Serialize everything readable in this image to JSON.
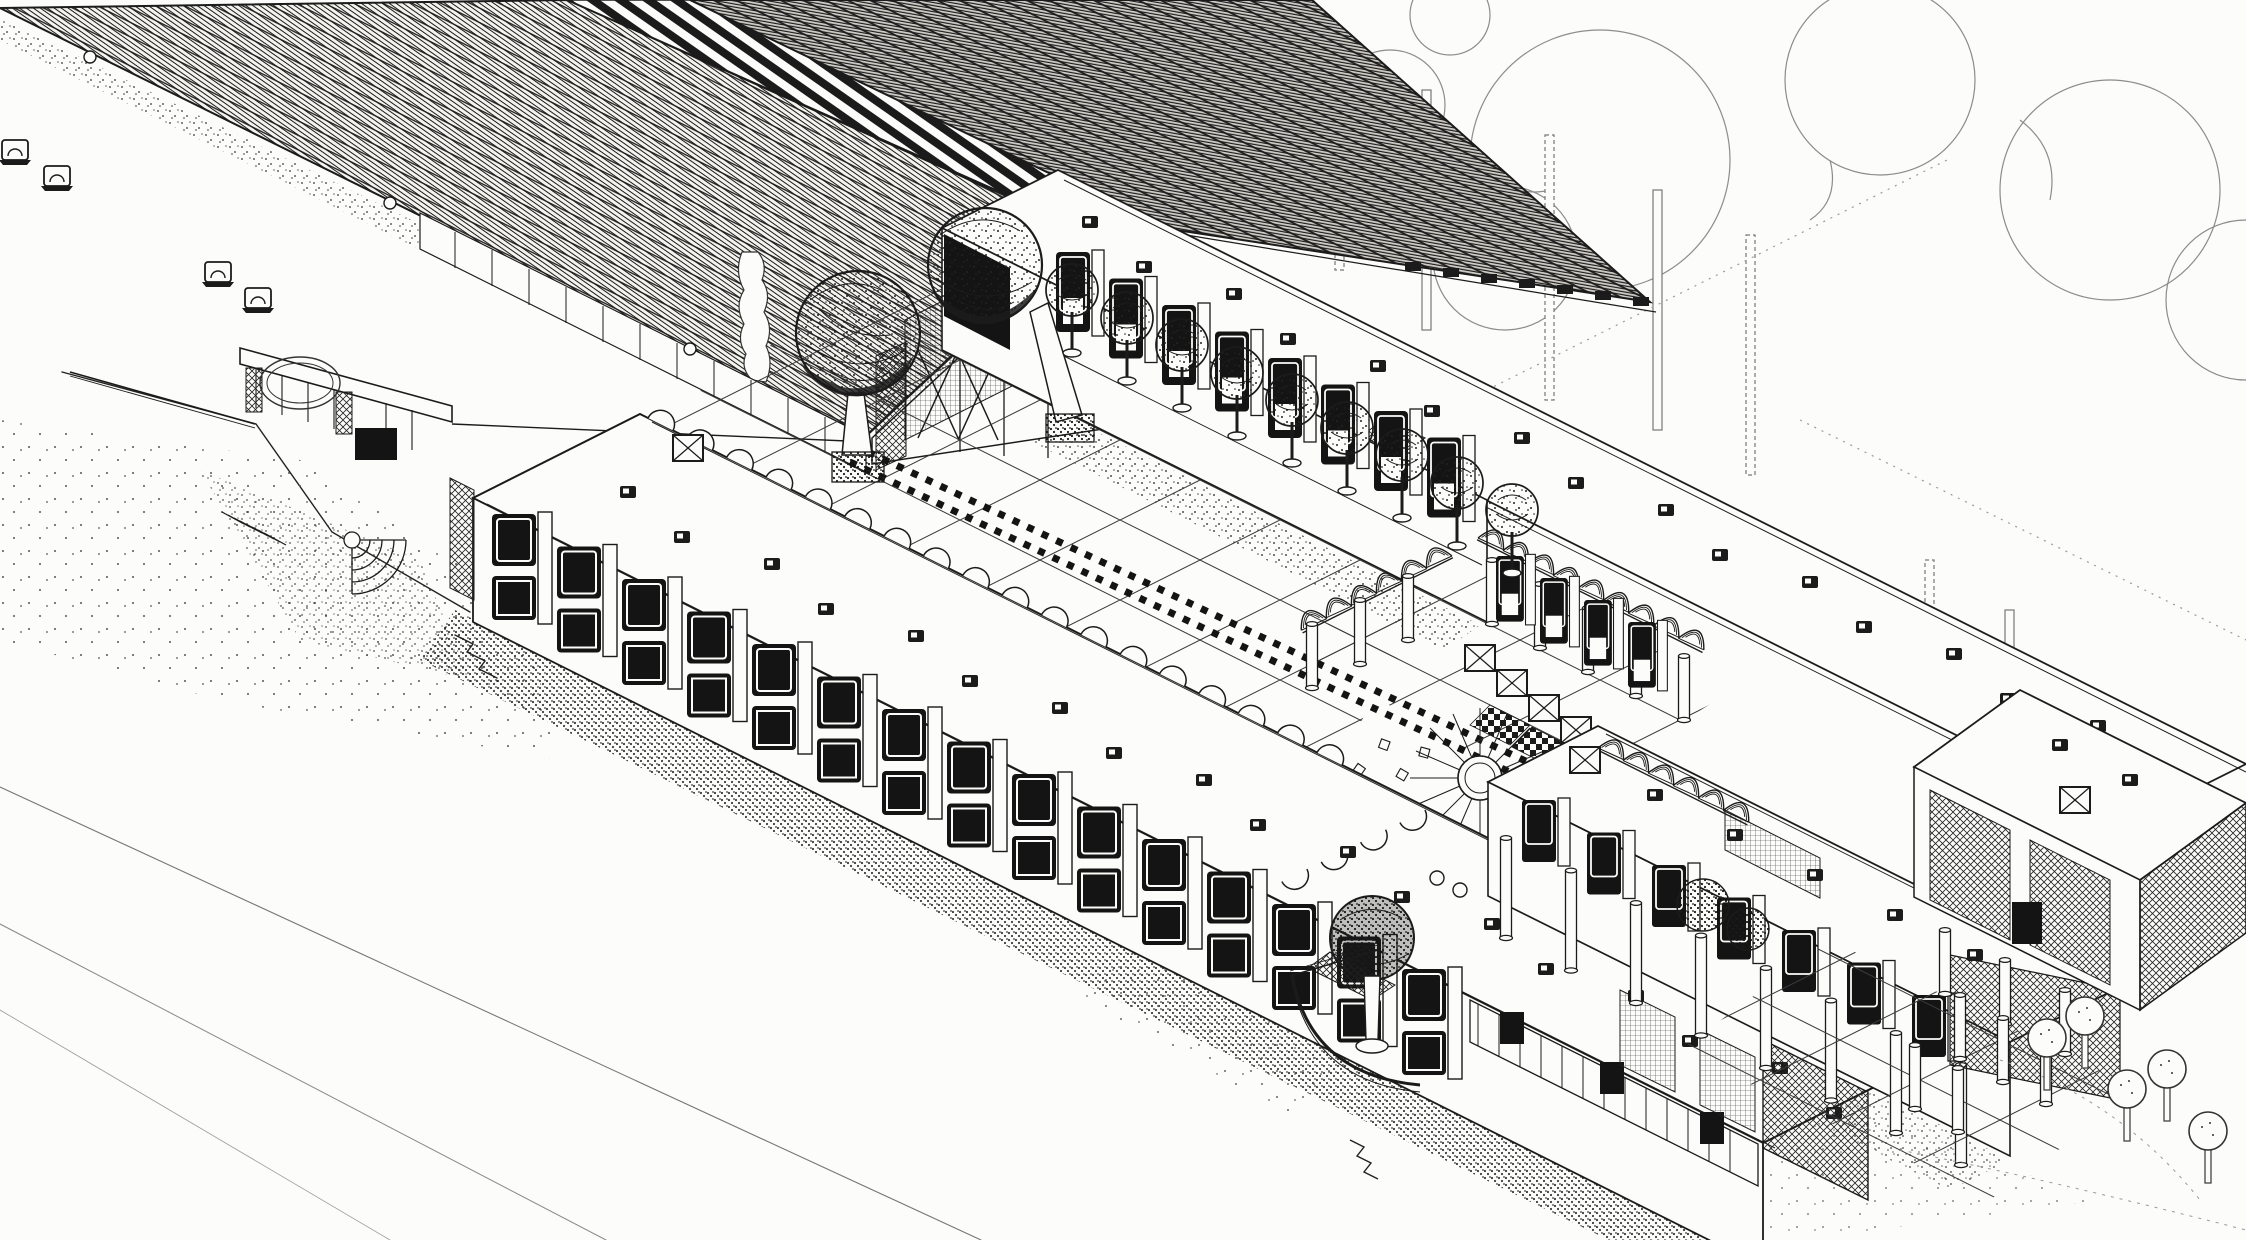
{
  "artwork": {
    "kind": "axonometric architectural ink drawing",
    "subject": "school building complex with gabled hall, flat-roofed classroom wings, courtyards, pergola trellises and trees",
    "aria_label": "Black and white axonometric line drawing of a school campus with a large hatched gable roof, courtyard wings, pergolas and trees"
  },
  "palette": {
    "paper": "#fcfcfa",
    "ink": "#1b1b1b",
    "mid": "#444444",
    "faint": "#8c8c8c"
  },
  "features": {
    "gabled_hall_roof_texture": "fine diagonal shingle hatching with striped ridge band and dark far slope",
    "courtyard_row_tree_count": 9,
    "large_canopy_tree_count": 2,
    "pyramid_skylight_row_count": 4,
    "bottom_right_tree_count": 5,
    "background_trees": "outline cloud canopies with bare trunks",
    "paving": "diagonal square grid with radial fan feature and checkered walk bands",
    "rooflights": "small dark square skylights dotted along flat roofs"
  }
}
